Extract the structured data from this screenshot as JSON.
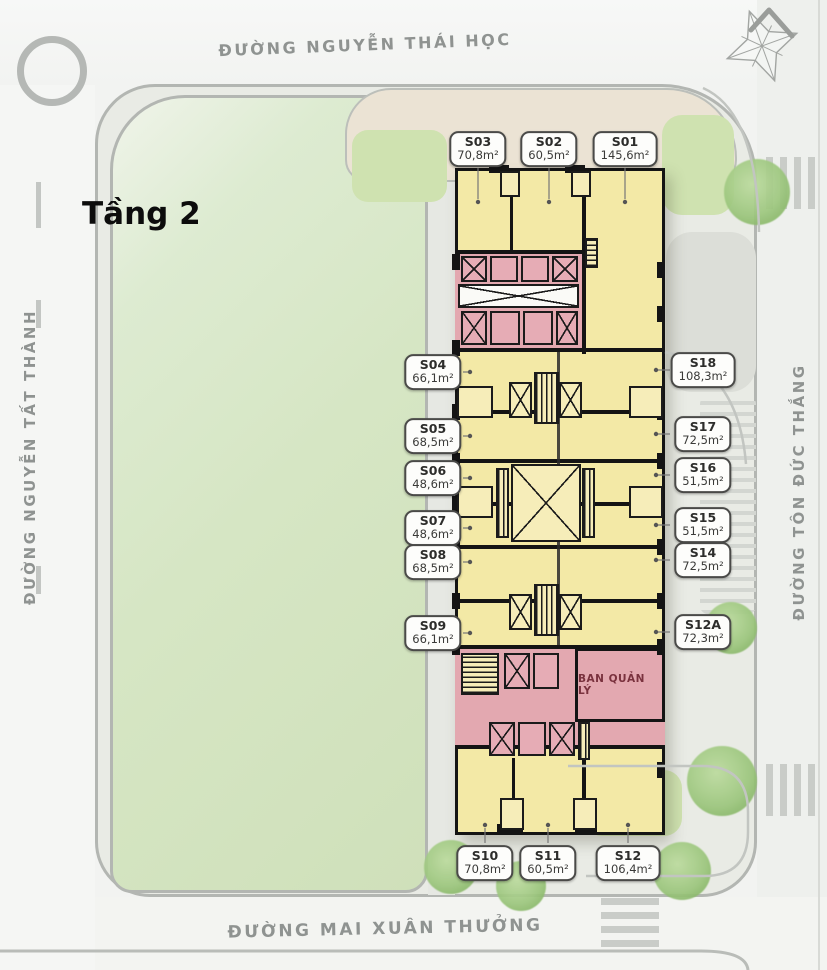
{
  "title": {
    "floor_label": "Tầng 2"
  },
  "streets": {
    "top": "ĐƯỜNG NGUYỄN THÁI HỌC",
    "left": "ĐƯỜNG NGUYỄN TẤT THÀNH",
    "right": "ĐƯỜNG TÔN ĐỨC THẮNG",
    "bottom": "ĐƯỜNG MAI XUÂN THƯỞNG"
  },
  "building": {
    "management_label": "BAN QUẢN LÝ"
  },
  "units": {
    "top": [
      {
        "id": "S03",
        "area": "70,8m²"
      },
      {
        "id": "S02",
        "area": "60,5m²"
      },
      {
        "id": "S01",
        "area": "145,6m²"
      }
    ],
    "left": [
      {
        "id": "S04",
        "area": "66,1m²"
      },
      {
        "id": "S05",
        "area": "68,5m²"
      },
      {
        "id": "S06",
        "area": "48,6m²"
      },
      {
        "id": "S07",
        "area": "48,6m²"
      },
      {
        "id": "S08",
        "area": "68,5m²"
      },
      {
        "id": "S09",
        "area": "66,1m²"
      }
    ],
    "right": [
      {
        "id": "S18",
        "area": "108,3m²"
      },
      {
        "id": "S17",
        "area": "72,5m²"
      },
      {
        "id": "S16",
        "area": "51,5m²"
      },
      {
        "id": "S15",
        "area": "51,5m²"
      },
      {
        "id": "S14",
        "area": "72,5m²"
      },
      {
        "id": "S12A",
        "area": "72,3m²"
      }
    ],
    "bottom": [
      {
        "id": "S10",
        "area": "70,8m²"
      },
      {
        "id": "S11",
        "area": "60,5m²"
      },
      {
        "id": "S12",
        "area": "106,4m²"
      }
    ]
  },
  "colors": {
    "unit_fill": "#f3e9a6",
    "core_pink": "#e3a8b0",
    "wall": "#141414",
    "park_green": "#d6e6c4",
    "management_text": "#7a323e",
    "street_text": "#8f9391"
  }
}
